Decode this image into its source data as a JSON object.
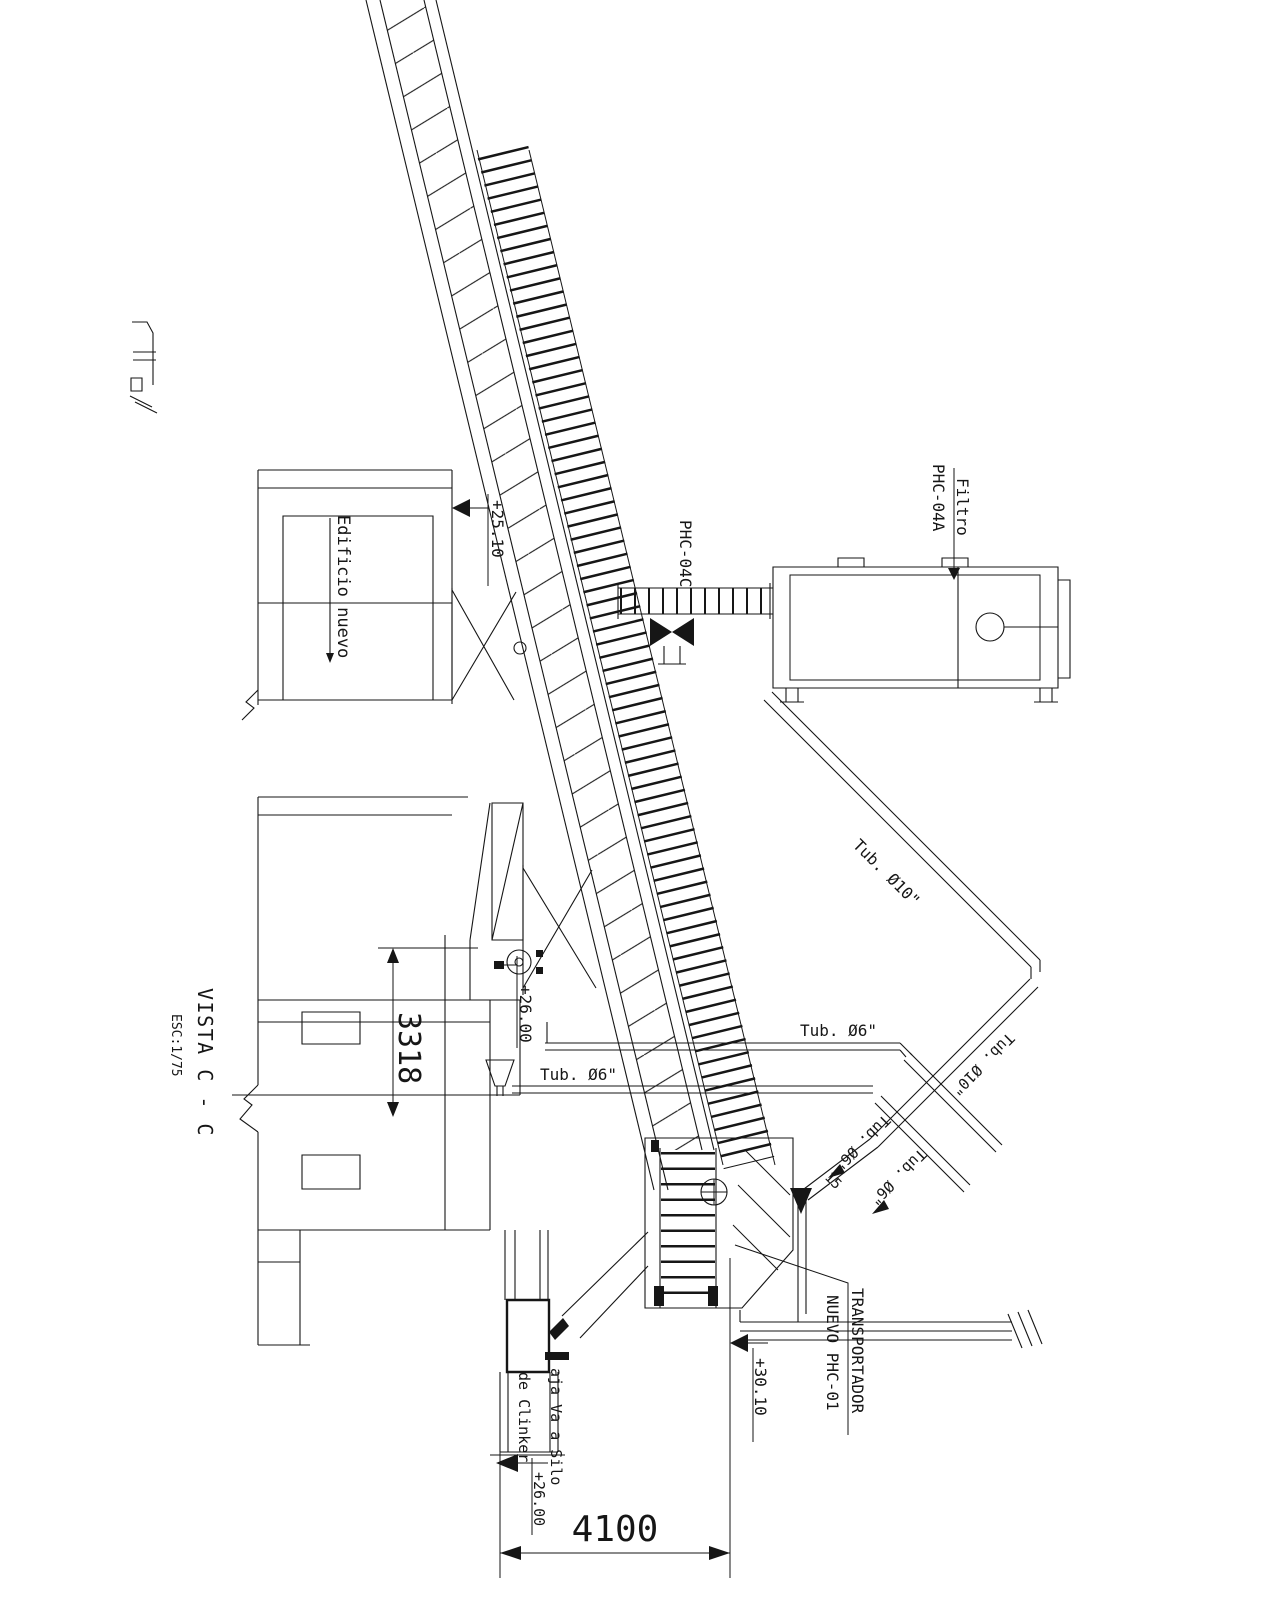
{
  "view": {
    "title": "VISTA C - C",
    "scale": "ESC:1/75"
  },
  "labels": {
    "building_new": "Edificio nuevo",
    "filter_line1": "Filtro",
    "filter_line2": "PHC-04A",
    "screw": "PHC-04C",
    "pipe10_a": "Tub. Ø10\"",
    "pipe10_b": "Tub. Ø10\"",
    "pipe6_h1": "Tub. Ø6\"",
    "pipe6_h2": "Tub. Ø6\"",
    "pipe6_d1": "Tub. Ø6\"",
    "pipe6_d2": "Tub. Ø6\"",
    "pipe_count": "15",
    "transporter_line1": "TRANSPORTADOR",
    "transporter_line2": "NUEVO  PHC-01",
    "chute_line1": "aja Va a Silo",
    "chute_line2": "de Clinker"
  },
  "elevations": {
    "building": "+25.10",
    "tail": "+26.00",
    "pipe": "+30.10",
    "chute": "+26.00"
  },
  "dimensions": {
    "height": "3318",
    "span": "4100"
  },
  "colors": {
    "ink": "#161616",
    "paper": "#ffffff"
  }
}
